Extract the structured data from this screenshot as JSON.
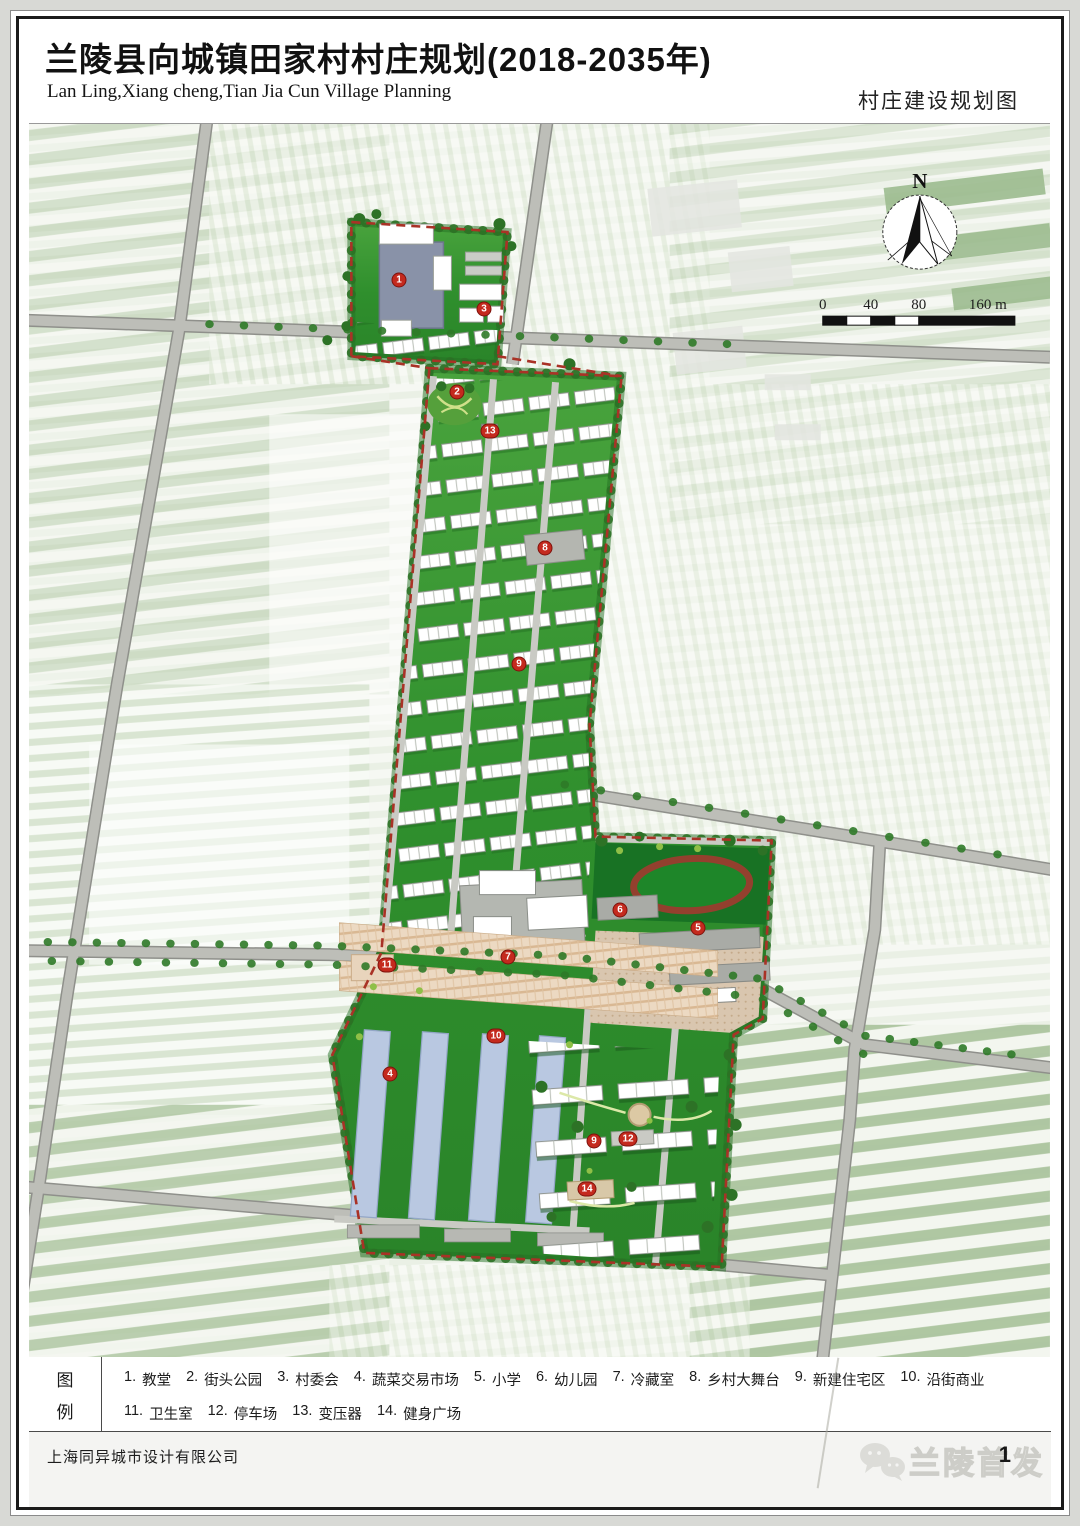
{
  "header": {
    "title_cn": "兰陵县向城镇田家村村庄规划(2018-2035年)",
    "title_en": "Lan Ling,Xiang cheng,Tian Jia Cun Village Planning",
    "map_label": "村庄建设规划图"
  },
  "map": {
    "compass_label": "N",
    "scale_ticks": [
      "0",
      "40",
      "80",
      "160 m"
    ],
    "markers": [
      {
        "num": "1",
        "label": "教堂",
        "x": 370,
        "y": 156
      },
      {
        "num": "3",
        "label": "村委会",
        "x": 455,
        "y": 185
      },
      {
        "num": "2",
        "label": "街头公园",
        "x": 428,
        "y": 268
      },
      {
        "num": "13",
        "label": "变压器",
        "x": 461,
        "y": 307
      },
      {
        "num": "8",
        "label": "乡村大舞台",
        "x": 516,
        "y": 424
      },
      {
        "num": "9",
        "label": "新建住宅区",
        "x": 490,
        "y": 540
      },
      {
        "num": "6",
        "label": "幼儿园",
        "x": 591,
        "y": 786
      },
      {
        "num": "5",
        "label": "小学",
        "x": 669,
        "y": 804
      },
      {
        "num": "7",
        "label": "冷藏室",
        "x": 479,
        "y": 833
      },
      {
        "num": "11",
        "label": "卫生室",
        "x": 358,
        "y": 841
      },
      {
        "num": "10",
        "label": "沿街商业",
        "x": 467,
        "y": 912
      },
      {
        "num": "4",
        "label": "蔬菜交易市场",
        "x": 361,
        "y": 950
      },
      {
        "num": "12",
        "label": "停车场",
        "x": 599,
        "y": 1015
      },
      {
        "num": "9",
        "label": "新建住宅区",
        "x": 565,
        "y": 1017
      },
      {
        "num": "14",
        "label": "健身广场",
        "x": 558,
        "y": 1065
      }
    ]
  },
  "legend": {
    "panel_char1": "图",
    "panel_char2": "例",
    "rows": [
      [
        {
          "num": "1.",
          "label": "教堂"
        },
        {
          "num": "2.",
          "label": "街头公园"
        },
        {
          "num": "3.",
          "label": "村委会"
        },
        {
          "num": "4.",
          "label": "蔬菜交易市场"
        },
        {
          "num": "5.",
          "label": "小学"
        },
        {
          "num": "6.",
          "label": "幼儿园"
        },
        {
          "num": "7.",
          "label": "冷藏室"
        },
        {
          "num": "8.",
          "label": "乡村大舞台"
        },
        {
          "num": "9.",
          "label": "新建住宅区"
        },
        {
          "num": "10.",
          "label": "沿街商业"
        }
      ],
      [
        {
          "num": "11.",
          "label": "卫生室"
        },
        {
          "num": "12.",
          "label": "停车场"
        },
        {
          "num": "13.",
          "label": "变压器"
        },
        {
          "num": "14.",
          "label": "健身广场"
        }
      ]
    ]
  },
  "footer": {
    "company": "上海同异城市设计有限公司",
    "watermark": "兰陵首发",
    "page_number": "1"
  },
  "colors": {
    "village_green": "#2f8f2d",
    "road_gray": "#bdbeb8",
    "boundary_red": "#a93226",
    "marker_red": "#c42a1e",
    "market_blue": "#b9c8e1",
    "school_paving_tan": "#d9c6af",
    "track_brown": "#93402e"
  }
}
